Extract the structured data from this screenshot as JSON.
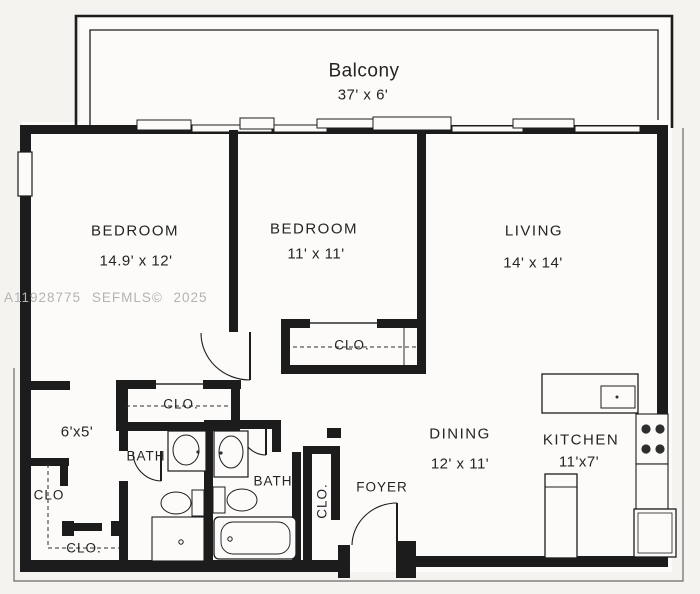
{
  "plan": {
    "watermark": "A11928775 SEFMLS© 2025",
    "balcony": {
      "name": "Balcony",
      "dims": "37' x 6'"
    },
    "bedroom1": {
      "name": "BEDROOM",
      "dims": "14.9' x 12'"
    },
    "bedroom2": {
      "name": "BEDROOM",
      "dims": "11' x 11'"
    },
    "living": {
      "name": "LIVING",
      "dims": "14' x 14'"
    },
    "dining": {
      "name": "DINING",
      "dims": "12' x 11'"
    },
    "kitchen": {
      "name": "KITCHEN",
      "dims": "11'x7'"
    },
    "bath1": {
      "name": "BATH"
    },
    "bath2": {
      "name": "BATH"
    },
    "foyer": {
      "name": "FOYER"
    },
    "hall": {
      "dims": "6'x5'"
    },
    "closets": {
      "bedroom2": "CLO.",
      "hall": "CLO.",
      "foyer": "CLO.",
      "left_upper": "CLO",
      "left_lower": "CLO."
    }
  },
  "colors": {
    "line": "#1c1c1c",
    "paper": "#f4f3f0",
    "room_fill": "#fcfbfa",
    "watermark": "#b4b3b1",
    "burner": "#2e2e2e"
  }
}
